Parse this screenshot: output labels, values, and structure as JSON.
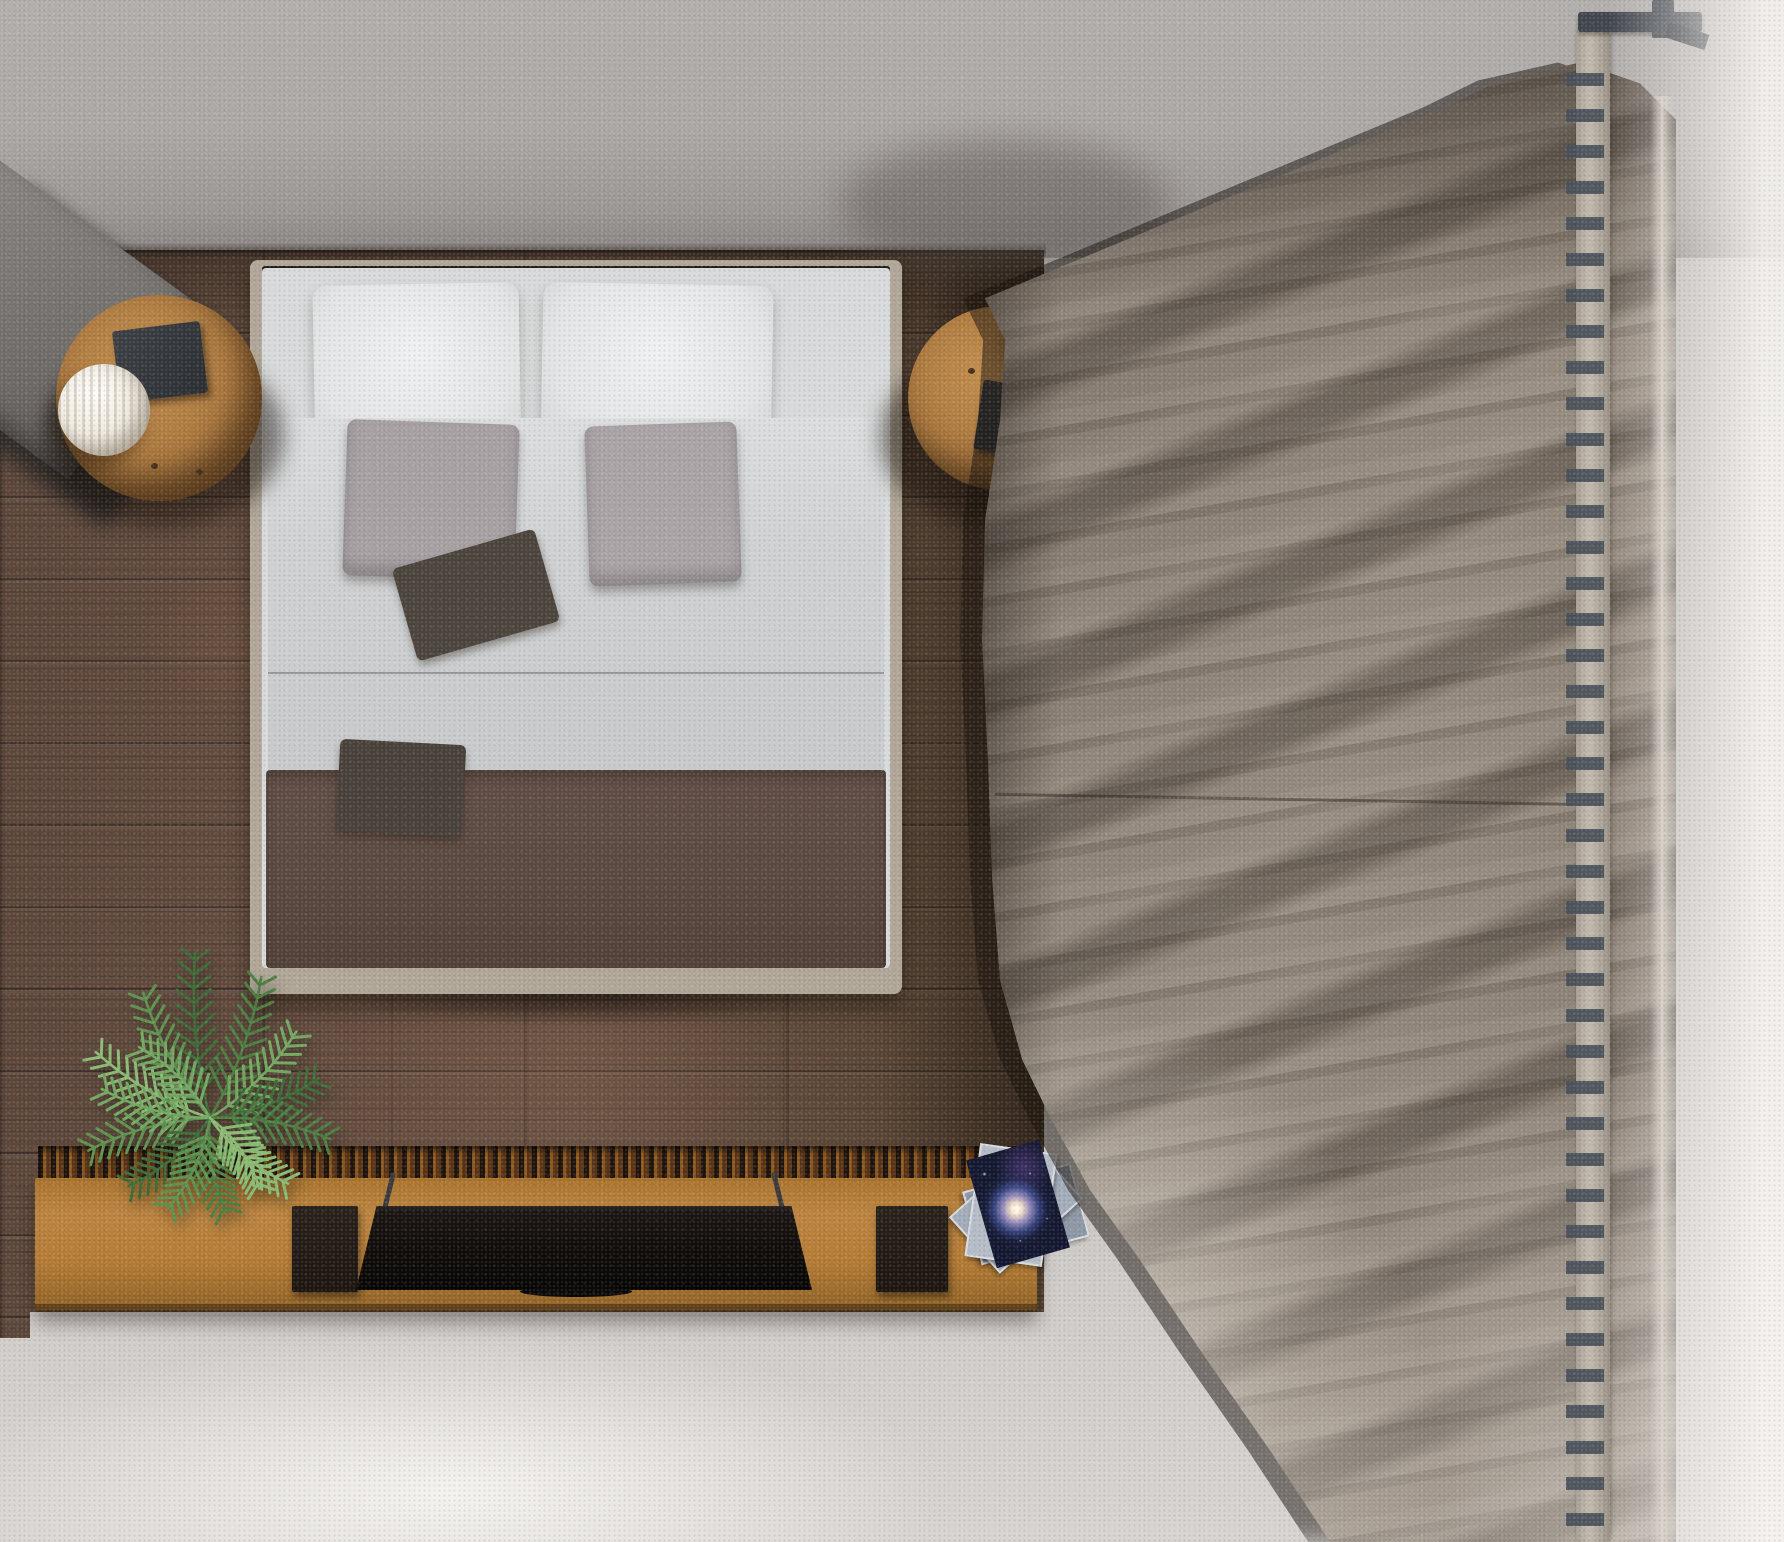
{
  "scene": {
    "title": "Top-down 3D render of a bedroom",
    "room": {
      "floor_wood_color": "#604a3d",
      "carpet_color": "#bfbbb8",
      "wall_band_color": "#aca8a6"
    },
    "objects": [
      {
        "name": "bed",
        "colors": {
          "frame": "#b0a798",
          "headboard": "#2a2119",
          "pillows": "#e9eaeb",
          "sheet": "#d9dadb",
          "duvet": "#cdcfd0",
          "cushions": "#a7a1a4",
          "accent_pillows": "#4b453e",
          "blanket": "#5b4941"
        }
      },
      {
        "name": "nightstand-left",
        "colors": {
          "wood": "#ab783e",
          "tray": "#34373c",
          "lamp": "#f2ede3"
        }
      },
      {
        "name": "nightstand-right",
        "colors": {
          "wood": "#ab783e",
          "tray": "#2f3237",
          "lamp": "#f2ede3"
        }
      },
      {
        "name": "armchair-corner",
        "colors": {
          "fabric": "#787471",
          "shadow": "#3c3a38"
        }
      },
      {
        "name": "curtain",
        "colors": {
          "fabric": "#8a7f75",
          "fold_shadow": "#6b6159",
          "highlight": "#9b9187",
          "rod": "#b9b0a4",
          "rings": "#49505a",
          "bracket": "#42474e"
        }
      },
      {
        "name": "media-console",
        "colors": {
          "wood": "#b57c35",
          "grille": "#2e2014"
        }
      },
      {
        "name": "tv",
        "colors": {
          "panel": "#120e0b",
          "legs": "#3b3b3d"
        }
      },
      {
        "name": "speaker-left",
        "colors": {
          "body": "#221b15"
        }
      },
      {
        "name": "speaker-right",
        "colors": {
          "body": "#221b15"
        }
      },
      {
        "name": "magazines",
        "cover_theme": "spiral-galaxy",
        "colors": {
          "top_cover": "#141830",
          "galaxy_core": "#fff7e8",
          "pages": "#b6bdc7"
        }
      },
      {
        "name": "plant",
        "type": "palm",
        "leaf_colors": [
          "#3f6b38",
          "#4e7d42",
          "#5f9150",
          "#74a862",
          "#8aba74"
        ]
      }
    ],
    "lighting": {
      "bright_wash_bottom_left": true,
      "vignette_right": true,
      "grain_noise": true
    }
  }
}
